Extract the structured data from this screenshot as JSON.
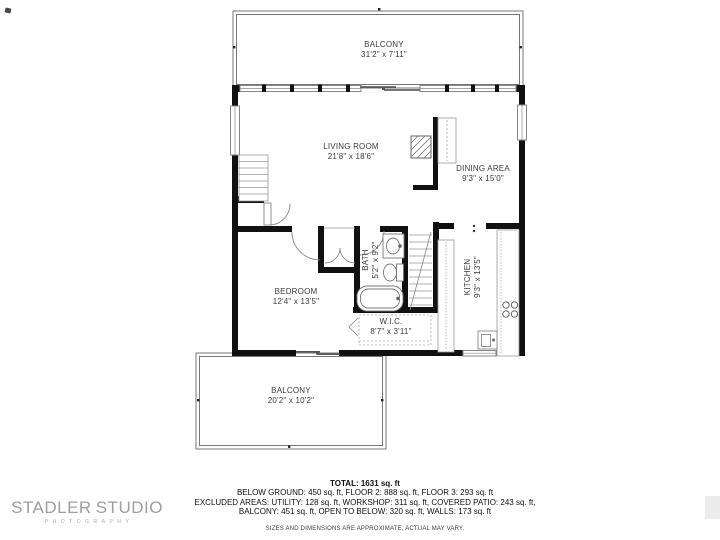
{
  "rooms": [
    {
      "name": "BALCONY",
      "dims": "31'2\" x 7'11\""
    },
    {
      "name": "LIVING ROOM",
      "dims": "21'8\" x 18'6\""
    },
    {
      "name": "DINING AREA",
      "dims": "9'3\" x 15'0\""
    },
    {
      "name": "BATH",
      "dims": "5'2\" x 9'2\""
    },
    {
      "name": "BEDROOM",
      "dims": "12'4\" x 13'5\""
    },
    {
      "name": "W.I.C.",
      "dims": "8'7\" x 3'11\""
    },
    {
      "name": "KITCHEN",
      "dims": "9'3\" x 13'5\""
    },
    {
      "name": "BALCONY",
      "dims": "20'2\" x 10'2\""
    }
  ],
  "summary": {
    "total": "TOTAL: 1631 sq. ft",
    "line1": "BELOW GROUND: 450 sq. ft, FLOOR 2: 888 sq. ft, FLOOR 3: 293 sq. ft",
    "line2": "EXCLUDED AREAS: UTILITY: 128 sq. ft, WORKSHOP: 311 sq. ft, COVERED PATIO: 243 sq. ft,",
    "line3": "BALCONY: 451 sq. ft, OPEN TO BELOW: 320 sq. ft, WALLS: 173 sq. ft",
    "disclaimer": "SIZES AND DIMENSIONS ARE APPROXIMATE, ACTUAL MAY VARY."
  },
  "logo": {
    "left": "STADLER",
    "right": "STUDIO",
    "subtitle": "PHOTOGRAPHY",
    "icon": "eye-icon",
    "accent_color": "#2e7e74",
    "text_color": "#9e9e9e"
  },
  "colors": {
    "wall": "#111111",
    "thin_line": "#888888",
    "background": "#ffffff"
  }
}
